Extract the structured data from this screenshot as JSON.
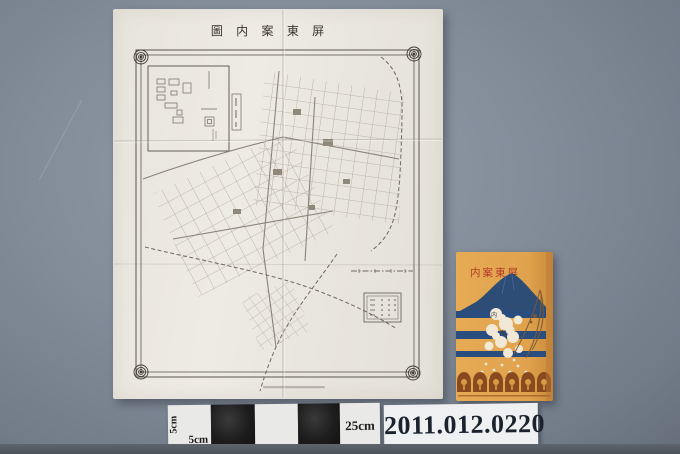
{
  "artifact_photo": {
    "catalog_number": "2011.012.0220",
    "scale_bar": {
      "left_vertical_label": "5cm",
      "left_label": "5cm",
      "right_label": "25cm"
    }
  },
  "map_sheet": {
    "title": "屏東案内圖",
    "title_display": "圖 内 案 東 屏"
  },
  "booklet_cover": {
    "title": "屏東案内",
    "title_display": "内案東屏",
    "blossom_chars": [
      "案",
      "内"
    ]
  },
  "colors": {
    "backdrop": "#828d9a",
    "paper": "#e9e6df",
    "map_line": "#8d877a",
    "booklet_orange": "#e2a54f",
    "booklet_navy": "#2b4d7d",
    "booklet_red": "#b23c28",
    "blossom_white": "#f1e9d6",
    "emblem_brown": "#8a4a1f",
    "label_bg": "#eef0f1",
    "label_text": "#1a222e",
    "scalebar_black": "#161616",
    "scalebar_white": "#e9eae8"
  }
}
